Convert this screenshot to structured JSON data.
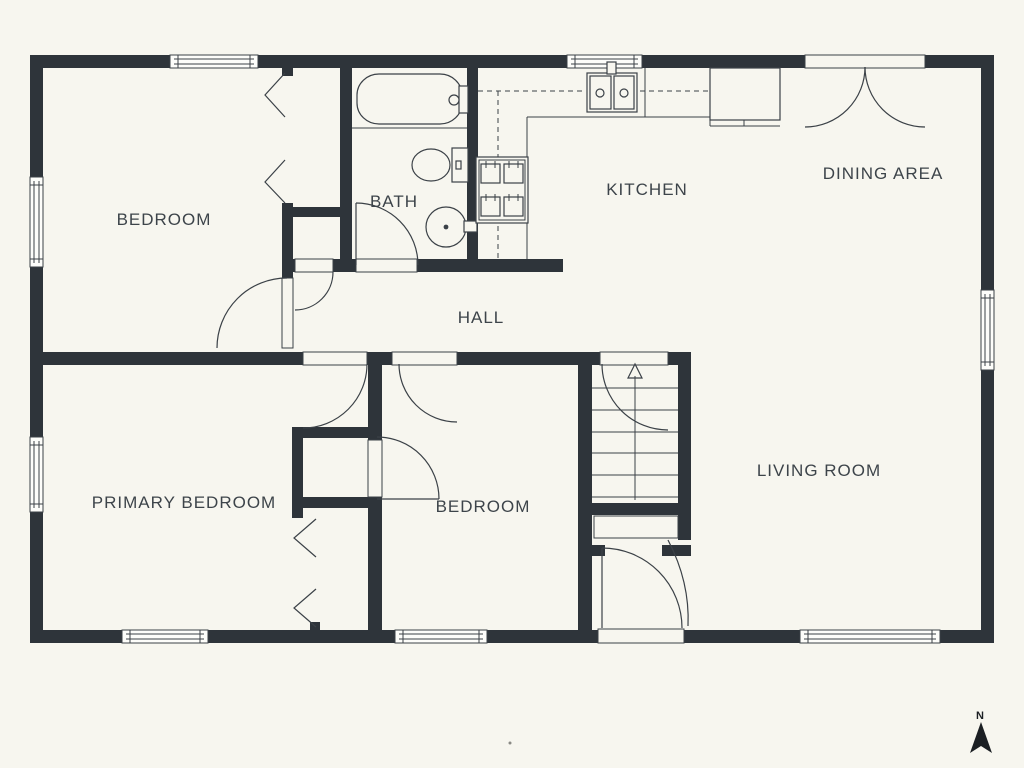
{
  "plan": {
    "type": "floor-plan",
    "rooms": {
      "bedroom1": {
        "label": "BEDROOM"
      },
      "bath": {
        "label": "BATH"
      },
      "kitchen": {
        "label": "KITCHEN"
      },
      "dining": {
        "label": "DINING AREA"
      },
      "hall": {
        "label": "HALL"
      },
      "primary": {
        "label": "PRIMARY BEDROOM"
      },
      "bedroom2": {
        "label": "BEDROOM"
      },
      "living": {
        "label": "LIVING ROOM"
      }
    },
    "compass": {
      "label": "N",
      "direction": "north"
    },
    "features": [
      "bathtub",
      "toilet",
      "round-sink",
      "kitchen-double-sink",
      "range-4-burners",
      "refrigerator",
      "counter",
      "upper-cabinets-dashed",
      "staircase-up-arrow",
      "double-french-doors-dining",
      "front-door",
      "closet-bifold-doors",
      "windows"
    ]
  },
  "colors": {
    "background": "#f7f6ef",
    "wall": "#2e343a",
    "line": "#3b4147",
    "text": "#3d444a",
    "compass": "#1b1f23"
  }
}
